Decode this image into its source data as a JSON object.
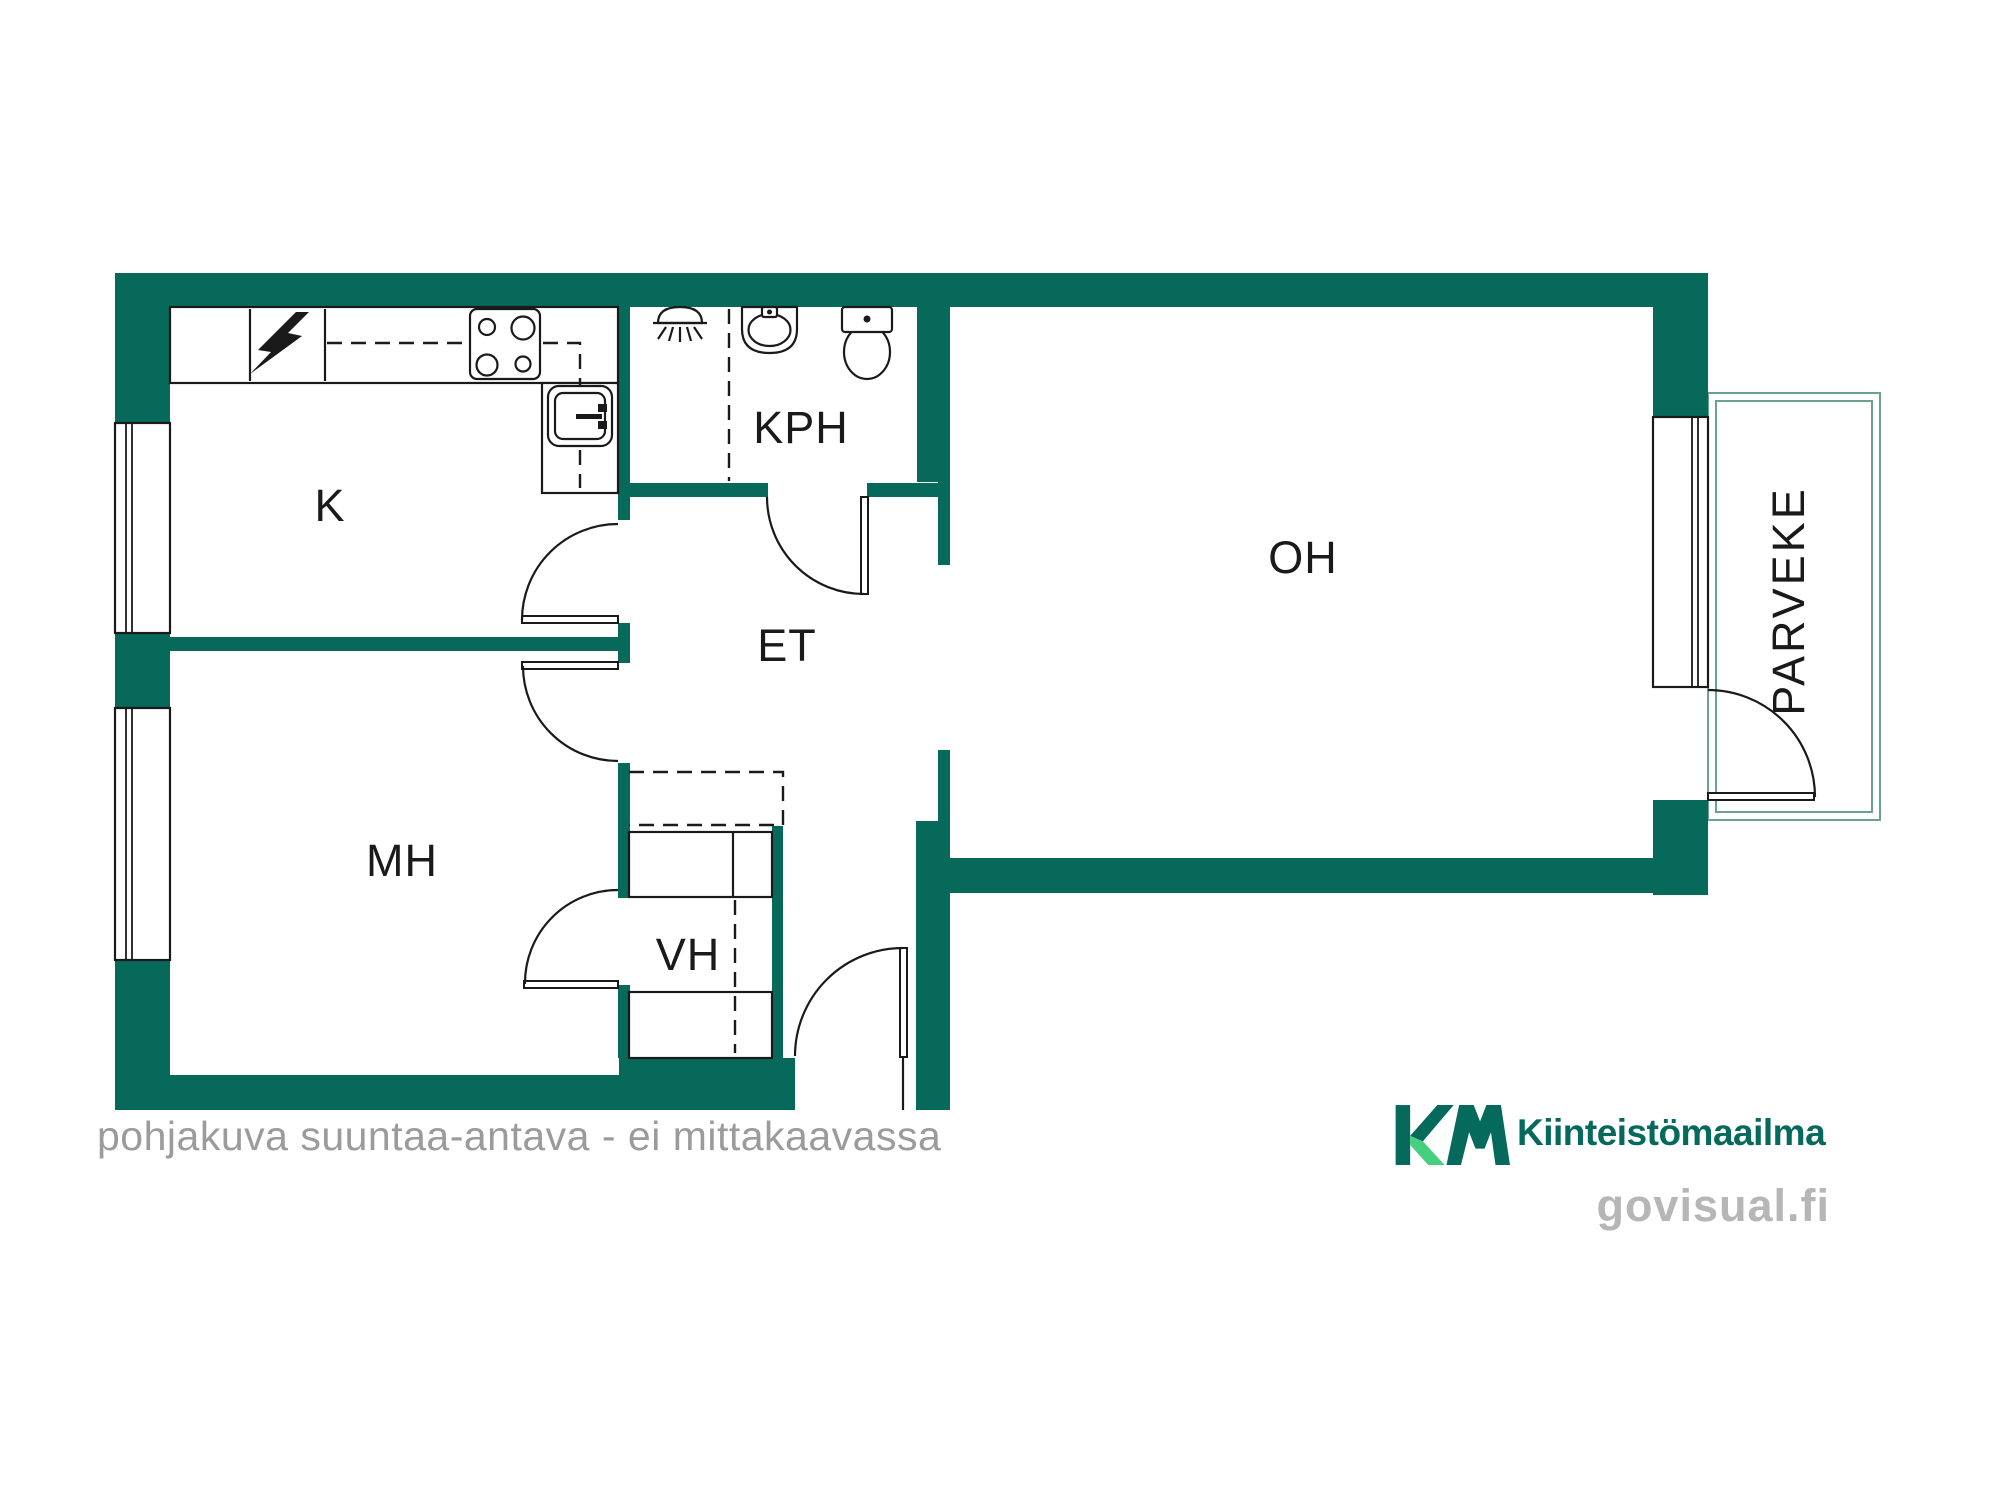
{
  "rooms": {
    "kitchen": {
      "label": "K"
    },
    "bathroom": {
      "label": "KPH"
    },
    "hall": {
      "label": "ET"
    },
    "living": {
      "label": "OH"
    },
    "bedroom": {
      "label": "MH"
    },
    "closet": {
      "label": "VH"
    },
    "balcony": {
      "label": "PARVEKE"
    }
  },
  "footer": {
    "disclaimer": "pohjakuva suuntaa-antava - ei mittakaavassa"
  },
  "branding": {
    "logo_monogram": "KM",
    "company": "Kiinteistömaailma",
    "watermark": "govisual.fi"
  },
  "colors": {
    "wall_green": "#06695a",
    "logo_green": "#05695c",
    "logo_accent_green": "#45d07e",
    "balcony_outline": "#69a195",
    "line_black": "#1a1a1a",
    "text_gray": "#9b9b9b",
    "watermark_gray": "#b6b6b6"
  }
}
